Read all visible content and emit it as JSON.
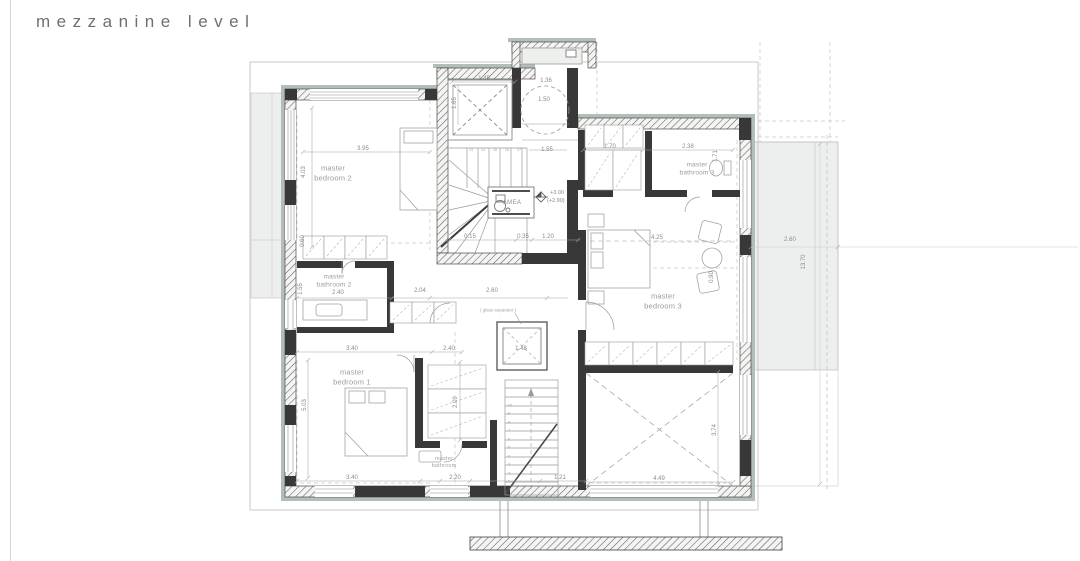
{
  "title": "mezzanine level",
  "colors": {
    "wall_face": "#b2bfb8",
    "wall_dark": "#383838",
    "line": "#9a9a9a",
    "dim_text": "#8a8a8a",
    "fill_light": "#edefee",
    "title_text": "#6f6f6f"
  },
  "labels": {
    "bedroom1": "master bedroom 1",
    "bedroom2": "master bedroom 2",
    "bedroom3": "master bedroom 3",
    "bathroom1": "master bathroom",
    "bathroom2": "master bathroom 2",
    "bathroom3": "master bathroom 3",
    "amea": "AMEA",
    "glass_note": "( glass separator )"
  },
  "levels": {
    "upper": "+3.00",
    "lower": "(+2.90)"
  },
  "dims": {
    "bedroom2_w": "3.95",
    "bedroom2_h": "4.03",
    "elevator_w": "1.45",
    "elevator_h": "1.65",
    "entry_w": "1.36",
    "entry_circle": "1.50",
    "landing_w": "1.55",
    "closet_top_w": "1.70",
    "bathroom3_w": "2.38",
    "bathroom3_h": "1.71",
    "bedroom3_w": "4.25",
    "bedroom3_chair": "0.90",
    "bathroom2_w": "2.40",
    "bathroom2_h": "1.55",
    "bathroom2_closet": "0.60",
    "hall_closet_w": "2.04",
    "corridor_w": "2.60",
    "shaft2_w": "1.48",
    "stair_d1": "0.15",
    "stair_d2": "0.35",
    "stair_d3": "1.20",
    "bedroom1_w_top": "3.40",
    "closet1_w": "2.40",
    "bedroom1_h": "5.03",
    "closet1_h": "2.09",
    "bedroom1_w_bottom": "3.40",
    "bathroom1_w": "2.20",
    "stair_w": "1.21",
    "void_w": "4.49",
    "void_h": "3.74",
    "balcony_w": "2.60",
    "balcony_h": "13.70"
  },
  "stairs": {
    "lower_steps": [
      "1",
      "2",
      "3",
      "4",
      "5",
      "6",
      "7",
      "8",
      "9",
      "10"
    ],
    "winder_steps": [
      "13",
      "14",
      "15",
      "16",
      "17"
    ]
  }
}
